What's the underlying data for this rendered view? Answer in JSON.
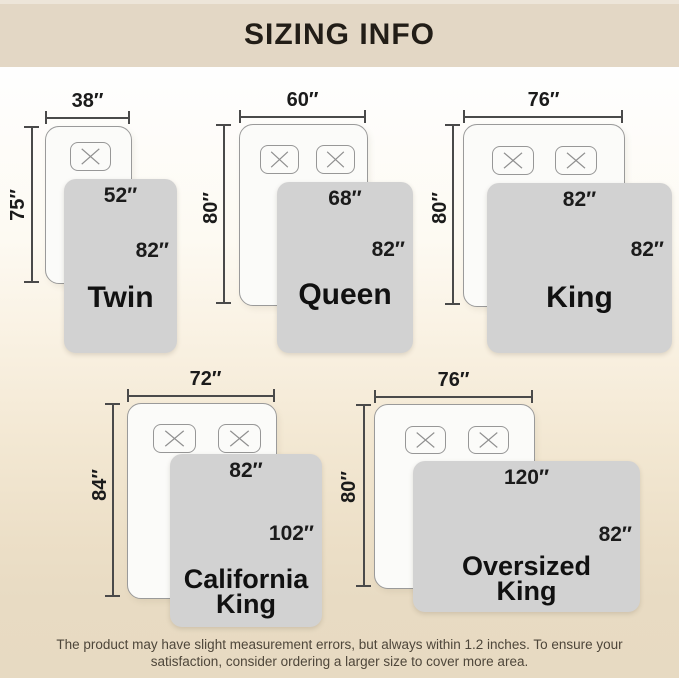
{
  "title": "SIZING INFO",
  "footer": {
    "line1": "The product may have slight measurement errors, but always within 1.2 inches. To ensure your",
    "line2": "satisfaction, consider ordering a larger size to cover more area."
  },
  "colors": {
    "header_bg": "#e3d7c5",
    "page_bottom_bg": "#e8dbc3",
    "blanket_fill": "#d2d2d2",
    "bed_fill": "#fbfbf9",
    "text": "#1b1b1b"
  },
  "icons": {
    "pillow_x": "✕"
  },
  "sizes": [
    {
      "name_line1": "Twin",
      "name_line2": "",
      "bed_width": "38″",
      "bed_length": "75″",
      "blanket_width": "52″",
      "blanket_length": "82″",
      "pillow_count": 1
    },
    {
      "name_line1": "Queen",
      "name_line2": "",
      "bed_width": "60″",
      "bed_length": "80″",
      "blanket_width": "68″",
      "blanket_length": "82″",
      "pillow_count": 2
    },
    {
      "name_line1": "King",
      "name_line2": "",
      "bed_width": "76″",
      "bed_length": "80″",
      "blanket_width": "82″",
      "blanket_length": "82″",
      "pillow_count": 2
    },
    {
      "name_line1": "California",
      "name_line2": "King",
      "bed_width": "72″",
      "bed_length": "84″",
      "blanket_width": "82″",
      "blanket_length": "102″",
      "pillow_count": 2
    },
    {
      "name_line1": "Oversized",
      "name_line2": "King",
      "bed_width": "76″",
      "bed_length": "80″",
      "blanket_width": "120″",
      "blanket_length": "82″",
      "pillow_count": 2
    }
  ]
}
